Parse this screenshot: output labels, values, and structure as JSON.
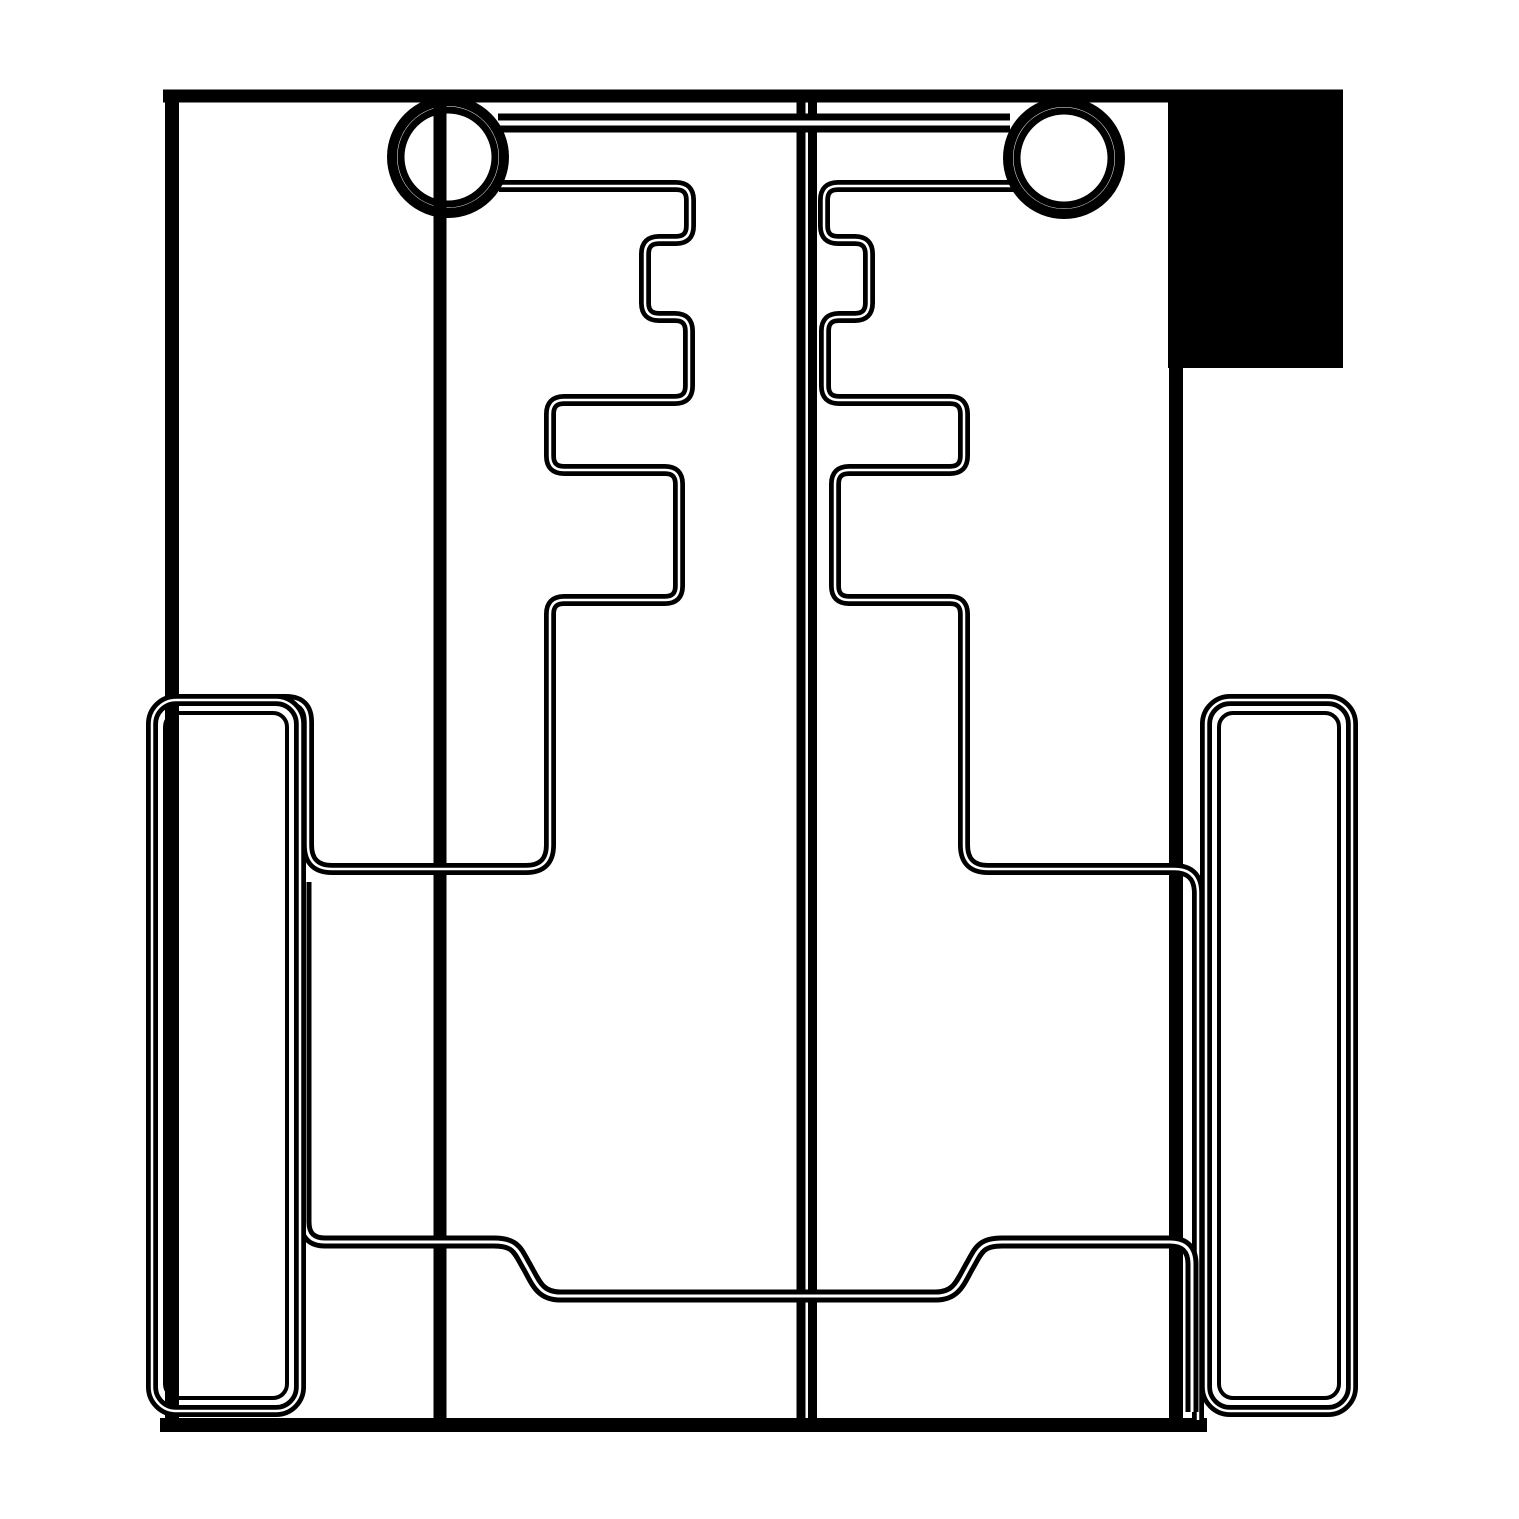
{
  "page": {
    "background": "#ffffff",
    "description": "Black and white CAD-style cut layout drawing of mirrored chassis plates, wheels, hubs and crossbar"
  },
  "drawing": {
    "canvas": {
      "width": 1519,
      "height": 1519,
      "bg": "#ffffff",
      "ink": "#000000"
    },
    "shapes": [
      {
        "name": "corner-block",
        "kind": "rectfill",
        "x": 1168,
        "y": 91,
        "w": 175,
        "h": 277
      },
      {
        "name": "frame-top-edge",
        "kind": "line",
        "x1": 163,
        "y1": 96,
        "x2": 1343,
        "y2": 96,
        "sw": 13
      },
      {
        "name": "frame-left-edge",
        "kind": "line",
        "x1": 172,
        "y1": 90,
        "x2": 172,
        "y2": 1431,
        "sw": 14
      },
      {
        "name": "frame-right-edge",
        "kind": "line",
        "x1": 1176,
        "y1": 90,
        "x2": 1176,
        "y2": 1431,
        "sw": 14
      },
      {
        "name": "frame-bottom-edge",
        "kind": "line",
        "x1": 160,
        "y1": 1425,
        "x2": 1207,
        "y2": 1425,
        "sw": 14
      },
      {
        "name": "axle-line-left",
        "kind": "line",
        "x1": 440,
        "y1": 96,
        "x2": 440,
        "y2": 1425,
        "sw": 13
      },
      {
        "name": "axle-line-mid-a",
        "kind": "line",
        "x1": 801,
        "y1": 96,
        "x2": 801,
        "y2": 1425,
        "sw": 9
      },
      {
        "name": "axle-line-mid-b",
        "kind": "line",
        "x1": 812.5,
        "y1": 96,
        "x2": 812.5,
        "y2": 1425,
        "sw": 9
      },
      {
        "name": "crossbar-top-edge",
        "kind": "line",
        "x1": 498,
        "y1": 123,
        "x2": 1010,
        "y2": 123,
        "sw": 19,
        "core": 5
      },
      {
        "name": "left-plate-contour",
        "kind": "path",
        "sw": 12,
        "core": 2.5,
        "d": "M 499,186 H 676 Q 690,186 690,200 V 226 Q 690,240 676,240 H 659 Q 645,240 645,254 V 303 Q 645,317 659,317 H 675 Q 689,317 689,331 V 386 Q 689,400 675,400 H 564 Q 550,400 550,414 V 456 Q 550,470 564,470 H 665 Q 679,470 679,484 V 586 Q 679,600 665,600 H 564 Q 550,600 550,614 V 845 Q 550,869 526,869 H 332 Q 308,869 308,845 V 722 Q 308,700 286,700 H 172"
      },
      {
        "name": "right-plate-contour",
        "kind": "path",
        "sw": 12,
        "core": 2.5,
        "d": "M 1015,186 H 838 Q 824,186 824,200 V 226 Q 824,240 838,240 H 855 Q 869,240 869,254 V 303 Q 869,317 855,317 H 839 Q 825,317 825,331 V 386 Q 825,400 839,400 H 950 Q 964,400 964,414 V 456 Q 964,470 950,470 H 849 Q 835,470 835,484 V 586 Q 835,600 849,600 H 950 Q 964,600 964,614 V 845 Q 964,869 988,869 H 1174 Q 1198,869 1198,893 V 1420"
      },
      {
        "name": "bottom-plate-contour",
        "kind": "path",
        "sw": 13,
        "core": 3,
        "d": "M 305,882 V 1222 Q 305,1242 325,1242 H 494 C 517,1242 518,1252 527,1267 C 536,1283 540,1296 560,1296 H 936 C 956,1296 960,1283 969,1267 C 978,1252 979,1242 1002,1242 H 1170 Q 1192,1242 1192,1264 V 1412"
      },
      {
        "name": "wheel-left-outer",
        "kind": "rect",
        "x": 152,
        "y": 700,
        "w": 148,
        "h": 711,
        "rx": 24,
        "sw": 12,
        "core": 2.5
      },
      {
        "name": "wheel-left-inner",
        "kind": "rect",
        "x": 165,
        "y": 713,
        "w": 122,
        "h": 685,
        "rx": 14,
        "sw": 4
      },
      {
        "name": "wheel-right-outer",
        "kind": "rect",
        "x": 1206,
        "y": 700,
        "w": 146,
        "h": 711,
        "rx": 24,
        "sw": 12,
        "core": 2.5
      },
      {
        "name": "wheel-right-inner",
        "kind": "rect",
        "x": 1219,
        "y": 713,
        "w": 120,
        "h": 685,
        "rx": 14,
        "sw": 4
      },
      {
        "name": "hub-left",
        "kind": "circleset",
        "cx": 448,
        "cy": 157,
        "rings": [
          {
            "r": 56,
            "w": 10
          },
          {
            "r": 47,
            "w": 7
          }
        ]
      },
      {
        "name": "hub-right",
        "kind": "circleset",
        "cx": 1064,
        "cy": 158,
        "rings": [
          {
            "r": 56,
            "w": 10
          },
          {
            "r": 47,
            "w": 7
          }
        ]
      }
    ]
  }
}
